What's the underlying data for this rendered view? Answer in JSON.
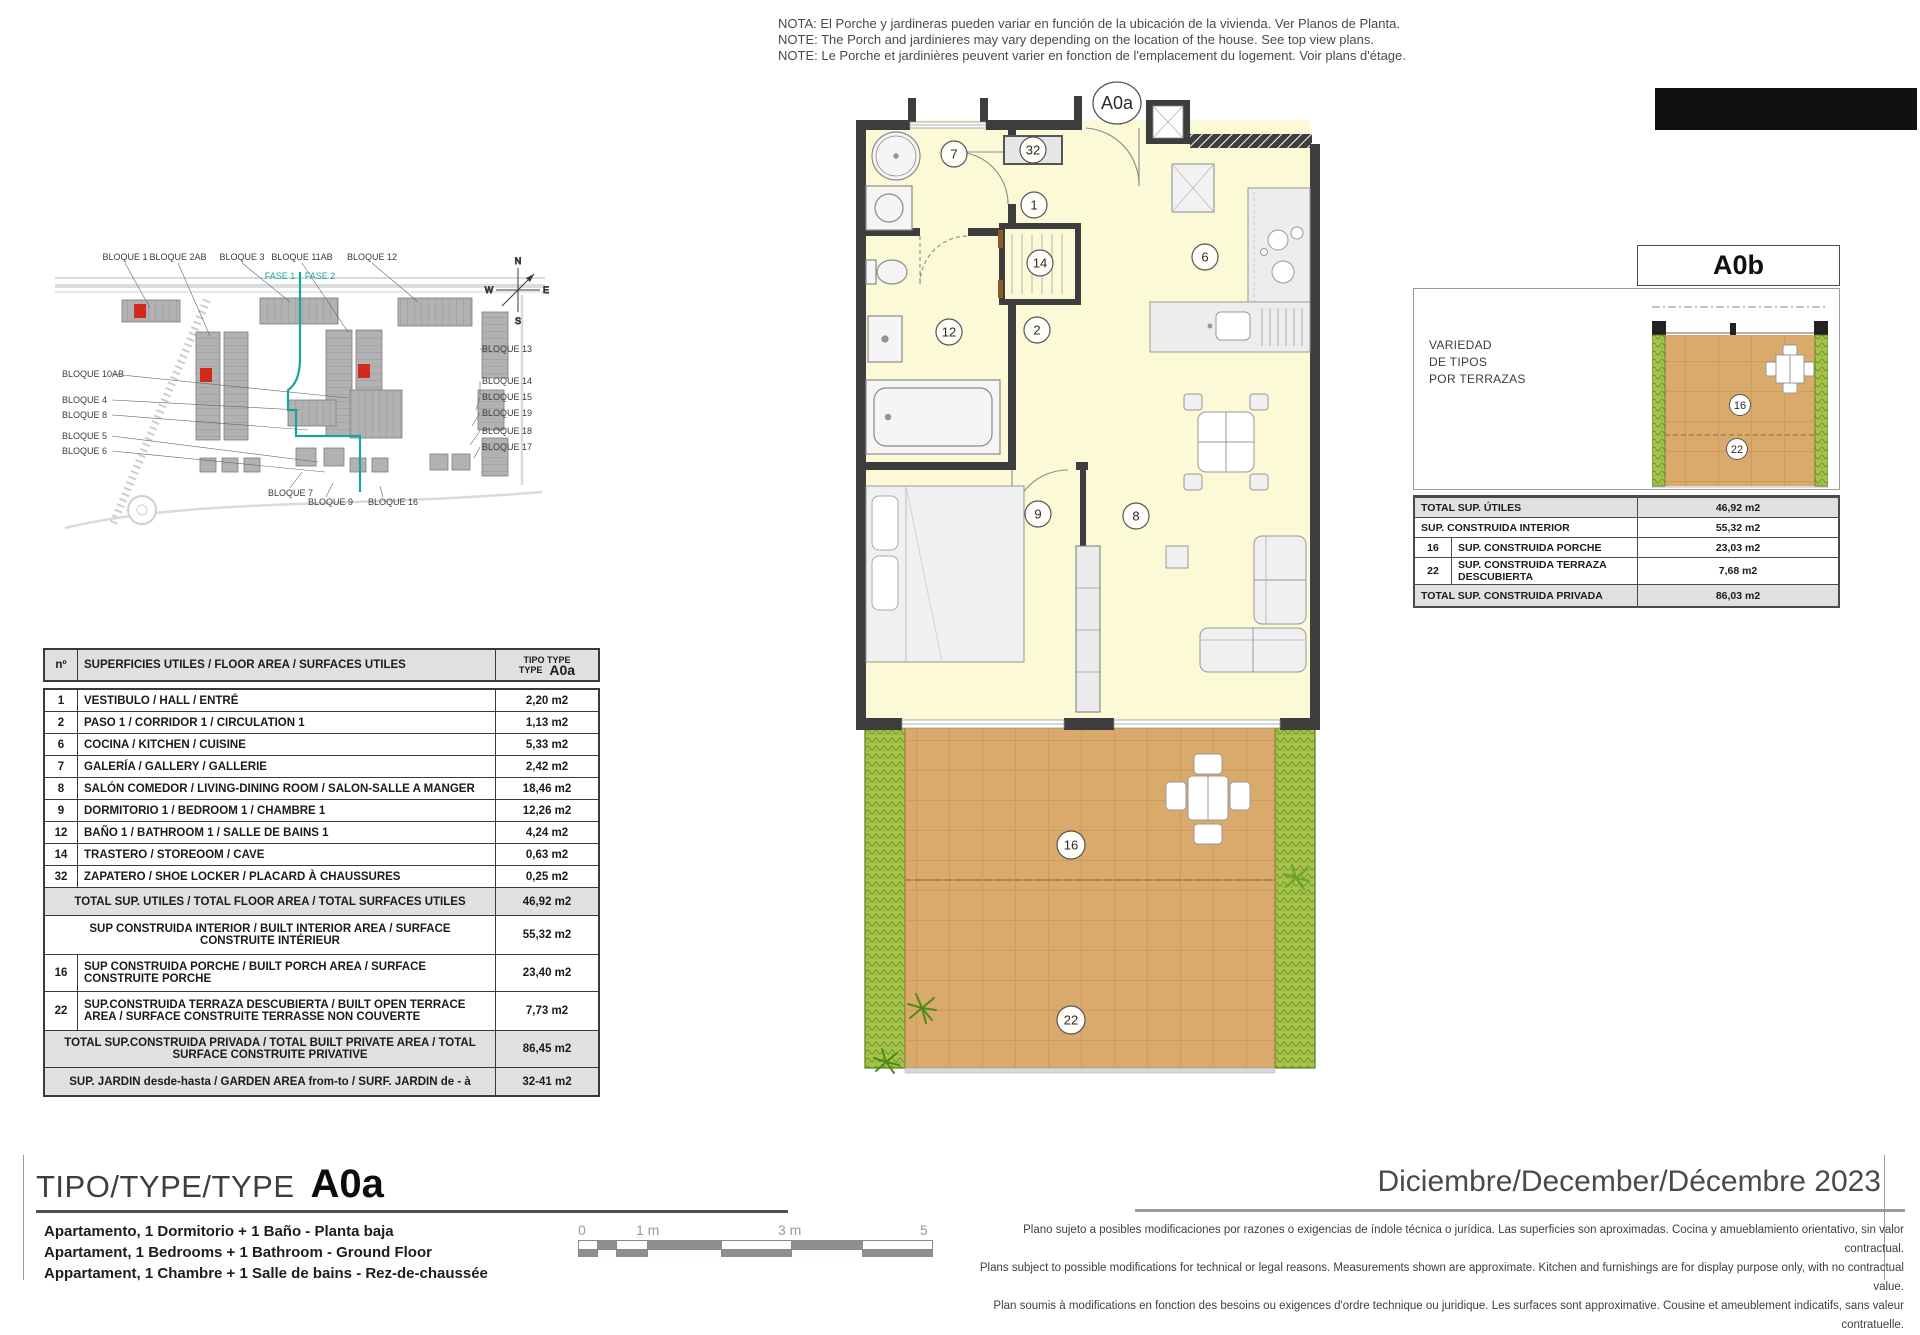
{
  "notes": {
    "lines": [
      "NOTA: El Porche y jardineras pueden variar en función de la ubicación de la vivienda. Ver Planos de Planta.",
      "NOTE: The Porch and jardinieres may vary depending on the location of the house. See top view plans.",
      "NOTE: Le Porche et jardinières peuvent varier en fonction de l'emplacement du logement. Voir plans d'étage."
    ]
  },
  "site": {
    "top_labels": [
      "BLOQUE 1",
      "BLOQUE 2AB",
      "BLOQUE 3",
      "BLOQUE 11AB",
      "BLOQUE 12"
    ],
    "fase1": "FASE 1",
    "fase2": "FASE 2",
    "left_labels": [
      "BLOQUE 10AB",
      "BLOQUE 4",
      "BLOQUE 8",
      "BLOQUE 5",
      "BLOQUE 6"
    ],
    "right_labels": [
      "BLOQUE 13",
      "BLOQUE 14",
      "BLOQUE 15",
      "BLOQUE 19",
      "BLOQUE 18",
      "BLOQUE 17"
    ],
    "bottom_labels": [
      "BLOQUE 7",
      "BLOQUE 9",
      "BLOQUE 16"
    ],
    "compass": {
      "n": "N",
      "s": "S",
      "e": "E",
      "w": "W"
    }
  },
  "plan": {
    "title": "A0a",
    "rooms": [
      "7",
      "32",
      "1",
      "14",
      "6",
      "12",
      "2",
      "9",
      "8",
      "16",
      "22"
    ]
  },
  "table": {
    "header": {
      "num": "nº",
      "title": "SUPERFICIES UTILES / FLOOR AREA / SURFACES UTILES",
      "tipo_line1": "TIPO TYPE",
      "tipo_line2": "TYPE",
      "code": "A0a"
    },
    "rows": [
      {
        "num": "1",
        "label": "VESTIBULO / HALL / ENTRÉ",
        "value": "2,20 m2"
      },
      {
        "num": "2",
        "label": "PASO 1 / CORRIDOR 1 / CIRCULATION 1",
        "value": "1,13 m2"
      },
      {
        "num": "6",
        "label": "COCINA / KITCHEN / CUISINE",
        "value": "5,33 m2"
      },
      {
        "num": "7",
        "label": "GALERÍA / GALLERY / GALLERIE",
        "value": "2,42 m2"
      },
      {
        "num": "8",
        "label": "SALÓN COMEDOR  / LIVING-DINING ROOM / SALON-SALLE A MANGER",
        "value": "18,46 m2"
      },
      {
        "num": "9",
        "label": "DORMITORIO 1 / BEDROOM 1 / CHAMBRE 1",
        "value": "12,26 m2"
      },
      {
        "num": "12",
        "label": "BAÑO 1 / BATHROOM 1 / SALLE DE BAINS 1",
        "value": "4,24 m2"
      },
      {
        "num": "14",
        "label": "TRASTERO / STOREOOM / CAVE",
        "value": "0,63 m2"
      },
      {
        "num": "32",
        "label": "ZAPATERO / SHOE LOCKER / PLACARD À CHAUSSURES",
        "value": "0,25 m2"
      }
    ],
    "totals": [
      {
        "num": "",
        "label": "TOTAL SUP. UTILES / TOTAL FLOOR AREA / TOTAL SURFACES UTILES",
        "value": "46,92 m2",
        "shaded": true,
        "center": true,
        "h": 27
      },
      {
        "num": "",
        "label": "SUP CONSTRUIDA INTERIOR / BUILT INTERIOR AREA /  SURFACE CONSTRUITE INTÉRIEUR",
        "value": "55,32 m2",
        "shaded": false,
        "center": true,
        "h": 38
      },
      {
        "num": "16",
        "label": "SUP CONSTRUIDA PORCHE  / BUILT PORCH  AREA / SURFACE CONSTRUITE PORCHE",
        "value": "23,40 m2",
        "shaded": false,
        "center": false,
        "h": 36
      },
      {
        "num": "22",
        "label": "SUP.CONSTRUIDA TERRAZA DESCUBIERTA  / BUILT OPEN TERRACE  AREA / SURFACE CONSTRUITE TERRASSE NON COUVERTE",
        "value": "7,73 m2",
        "shaded": false,
        "center": false,
        "h": 38
      },
      {
        "num": "",
        "label": "TOTAL SUP.CONSTRUIDA PRIVADA / TOTAL  BUILT PRIVATE AREA / TOTAL SURFACE CONSTRUITE PRIVATIVE",
        "value": "86,45 m2",
        "shaded": true,
        "center": true,
        "h": 36
      },
      {
        "num": "",
        "label": "SUP. JARDIN desde-hasta / GARDEN AREA from-to / SURF. JARDIN  de - à",
        "value": "32-41 m2",
        "shaded": true,
        "center": true,
        "h": 27
      }
    ]
  },
  "variant": {
    "title": "A0b",
    "caption": [
      "VARIEDAD",
      "DE TIPOS",
      "POR TERRAZAS"
    ],
    "porch": "16",
    "terrace": "22",
    "rows": [
      {
        "num": "",
        "label": "TOTAL SUP. ÚTILES",
        "value": "46,92 m2",
        "shaded": true
      },
      {
        "num": "",
        "label": "SUP. CONSTRUIDA INTERIOR",
        "value": "55,32 m2",
        "shaded": false
      },
      {
        "num": "16",
        "label": "SUP. CONSTRUIDA  PORCHE",
        "value": "23,03 m2",
        "shaded": false
      },
      {
        "num": "22",
        "label": "SUP. CONSTRUIDA TERRAZA DESCUBIERTA",
        "value": "7,68 m2",
        "shaded": false
      },
      {
        "num": "",
        "label": "TOTAL SUP. CONSTRUIDA PRIVADA",
        "value": "86,03 m2",
        "shaded": true
      }
    ]
  },
  "footer": {
    "tipo_prefix": "TIPO/TYPE/TYPE",
    "tipo_code": "A0a",
    "descriptions": [
      "Apartamento, 1 Dormitorio + 1 Baño - Planta baja",
      "Apartament, 1 Bedrooms + 1 Bathroom - Ground Floor",
      "Appartament, 1 Chambre + 1 Salle de bains - Rez-de-chaussée"
    ],
    "date": "Diciembre/December/Décembre 2023",
    "scale_labels": [
      "0",
      "1 m",
      "3 m",
      "5 m"
    ],
    "disclaimer": [
      "Plano sujeto a posibles modificaciones por razones o exigencias de índole técnica o jurídica. Las superficies son aproximadas. Cocina y amueblamiento orientativo, sin valor contractual.",
      "Plans subject to possible modifications for technical or legal reasons. Measurements shown are approximate. Kitchen and furnishings are for display purpose only, with no contractual value.",
      "Plan soumis à modifications en fonction des besoins ou exigences d'ordre technique ou juridique. Les surfaces sont approximative. Cousine et ameublement indicatifs, sans valeur contratuelle."
    ]
  },
  "colors": {
    "wall": "#3d3d3d",
    "interior": "#fcf9d6",
    "porch_tile": "#d9aa6c",
    "planter_green": "#a6c44a",
    "phase_teal": "#19a2a2",
    "highlight_red": "#d42a1e",
    "table_shade": "#e0e0e0"
  }
}
